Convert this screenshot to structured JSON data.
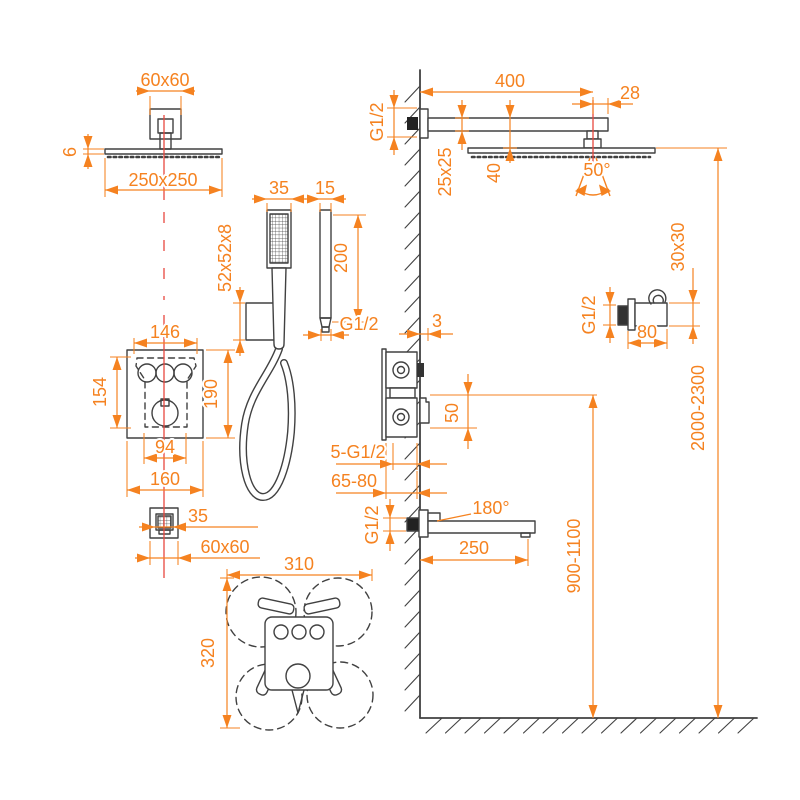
{
  "drawing": {
    "kind": "shower-system-installation-diagram",
    "colors": {
      "dimension": "#F58220",
      "line": "#414141",
      "centerline": "#E8473F",
      "background": "#FFFFFF"
    }
  },
  "labels": {
    "ceil_flange": "60x60",
    "ceil_thickness": "6",
    "ceil_head": "250x250",
    "hs_width": "35",
    "elbow_width": "15",
    "holder_size": "52x52x8",
    "elbow_length": "200",
    "elbow_thread": "G1/2",
    "valve_width_top": "146",
    "valve_height_inner": "154",
    "valve_height": "190",
    "valve_width_inner": "94",
    "valve_width": "160",
    "outlet_inner": "35",
    "outlet_size": "60x60",
    "spray_width": "310",
    "spray_height": "320",
    "arm_length": "400",
    "arm_offset": "28",
    "arm_thread": "G1/2",
    "arm_section": "25x25",
    "head_drop": "40",
    "head_tilt": "50°",
    "bracket_size": "30x30",
    "bracket_thread": "G1/2",
    "bracket_length": "80",
    "trim_gap": "3",
    "trim_height": "50",
    "valve_ports": "5-G1/2",
    "install_depth": "65-80",
    "spout_swivel": "180°",
    "spout_length": "250",
    "spout_thread": "G1/2",
    "spout_height": "900-1100",
    "head_height": "2000-2300"
  }
}
